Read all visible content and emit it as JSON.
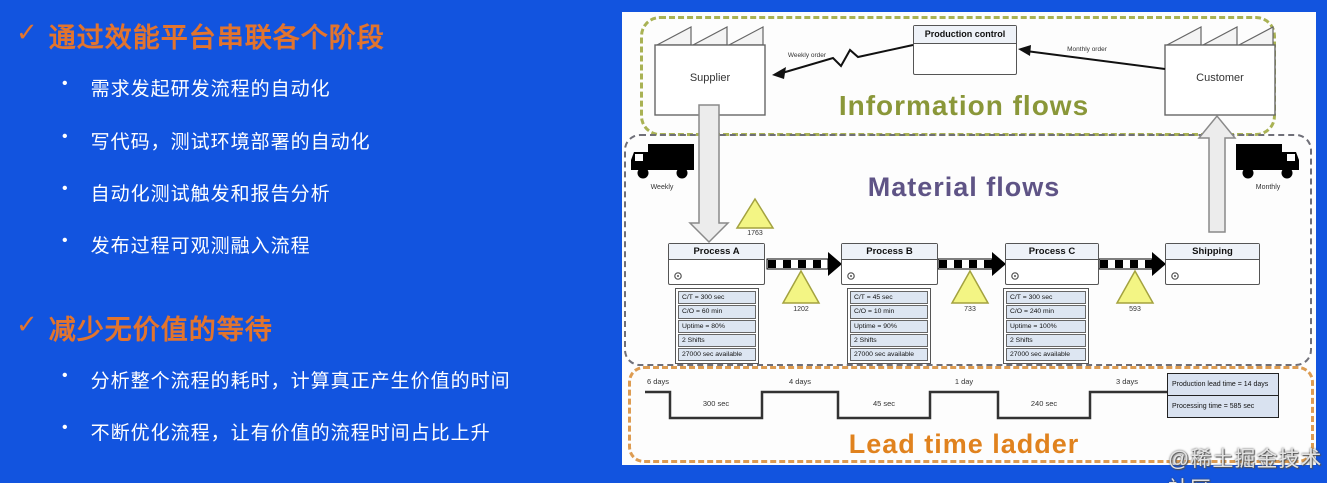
{
  "left": {
    "bullet_marker": "•",
    "section1": {
      "check": "✓",
      "heading": "通过效能平台串联各个阶段",
      "bullets": [
        "需求发起研发流程的自动化",
        "写代码，测试环境部署的自动化",
        "自动化测试触发和报告分析",
        "发布过程可观测融入流程"
      ]
    },
    "section2": {
      "check": "✓",
      "heading": "减少无价值的等待",
      "bullets": [
        "分析整个流程的耗时，计算真正产生价值的时间",
        "不断优化流程，让有价值的流程时间占比上升"
      ]
    }
  },
  "diagram": {
    "info": {
      "title": "Information flows",
      "production_control": "Production control",
      "supplier": "Supplier",
      "customer": "Customer",
      "weekly_order": "Weekly order",
      "monthly_order": "Monthly order"
    },
    "material": {
      "title": "Material flows",
      "truck_left_label": "Weekly",
      "truck_right_label": "Monthly",
      "inventory": [
        "1763",
        "1202",
        "733",
        "593"
      ],
      "process_a": {
        "name": "Process A",
        "rows": [
          "C/T = 300 sec",
          "C/O = 60 min",
          "Uptime = 80%",
          "2 Shifts",
          "27000 sec available"
        ]
      },
      "process_b": {
        "name": "Process B",
        "rows": [
          "C/T = 45 sec",
          "C/O = 10 min",
          "Uptime = 90%",
          "2 Shifts",
          "27000 sec available"
        ]
      },
      "process_c": {
        "name": "Process C",
        "rows": [
          "C/T = 300 sec",
          "C/O = 240 min",
          "Uptime = 100%",
          "2 Shifts",
          "27000 sec available"
        ]
      },
      "shipping": {
        "name": "Shipping"
      }
    },
    "lead": {
      "title": "Lead time ladder",
      "days": [
        "6 days",
        "4 days",
        "1 day",
        "3 days"
      ],
      "secs": [
        "300 sec",
        "45 sec",
        "240 sec"
      ],
      "summary": [
        "Production lead time = 14 days",
        "Processing time = 585 sec"
      ]
    }
  },
  "watermark": "@稀土掘金技术社区",
  "colors": {
    "background": "#1254df",
    "accent_orange": "#e2742e",
    "info_title": "#8a9739",
    "material_title": "#5f5486",
    "lead_title": "#e0821e",
    "inventory_triangle": "#f3f584"
  }
}
